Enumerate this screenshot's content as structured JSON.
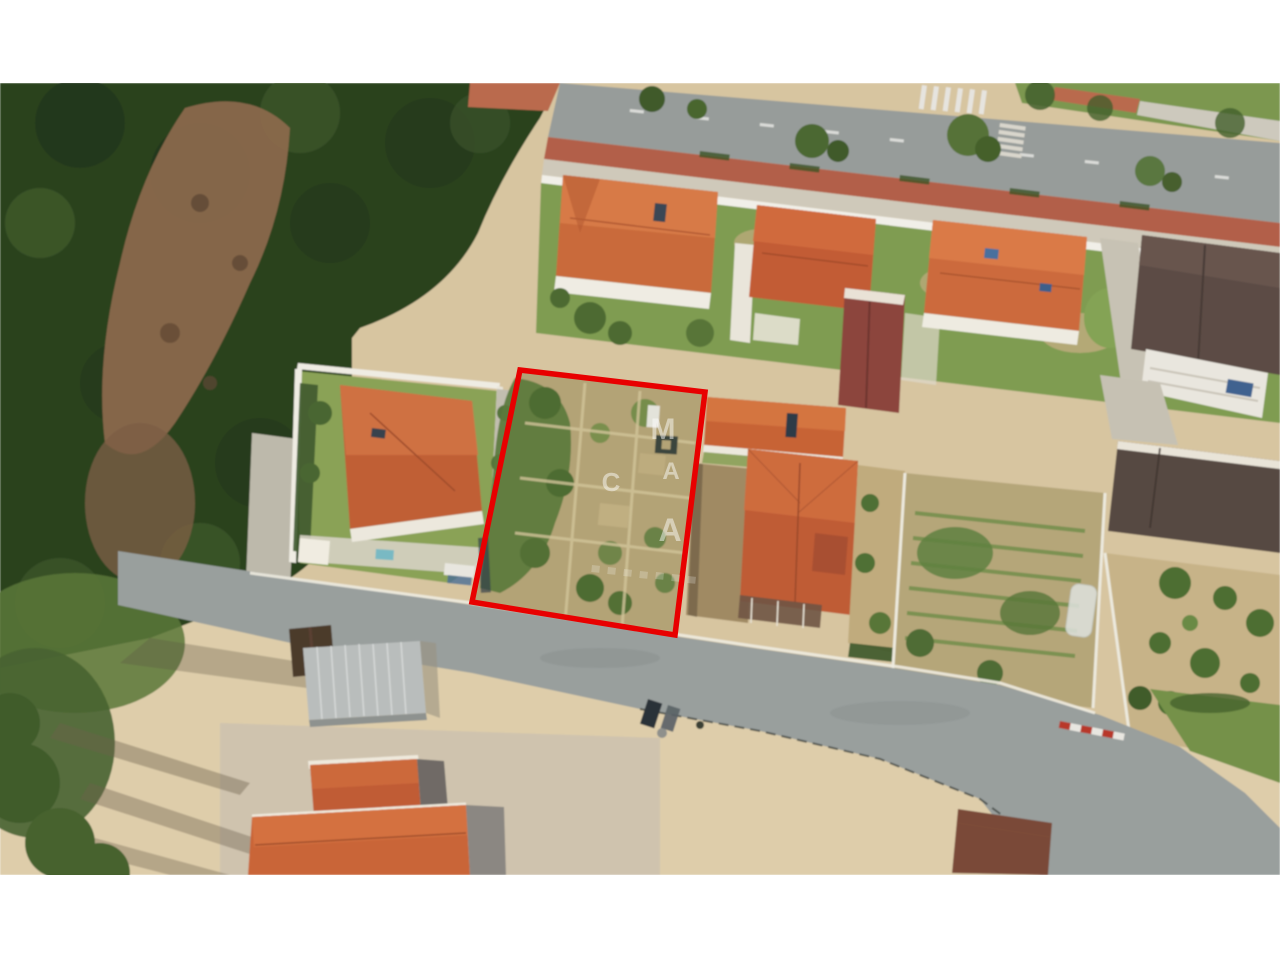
{
  "scene": {
    "type": "aerial-satellite-photo",
    "description": "Oblique aerial view of a residential neighborhood with a garden parcel outlined in red",
    "letterbox_color": "#ffffff",
    "outline_color": "#e80000"
  },
  "watermark": {
    "color": "#ffffff",
    "letters": [
      {
        "char": "M"
      },
      {
        "char": "A"
      },
      {
        "char": "C"
      },
      {
        "char": "A"
      }
    ]
  },
  "palette": {
    "forest": "#2c421f",
    "clearing_brown": "#8a684c",
    "road_asphalt": "#979c9a",
    "bike_lane_red": "#b25f48",
    "roof_orange": "#c96a3b",
    "roof_dark_brown": "#5c4c45",
    "roof_maroon": "#8c453c",
    "grass_green": "#7f9c51",
    "plot_sand": "#b3a376",
    "ground_sand": "#d7c5a0",
    "warehouse_grey": "#b9bdbc"
  }
}
